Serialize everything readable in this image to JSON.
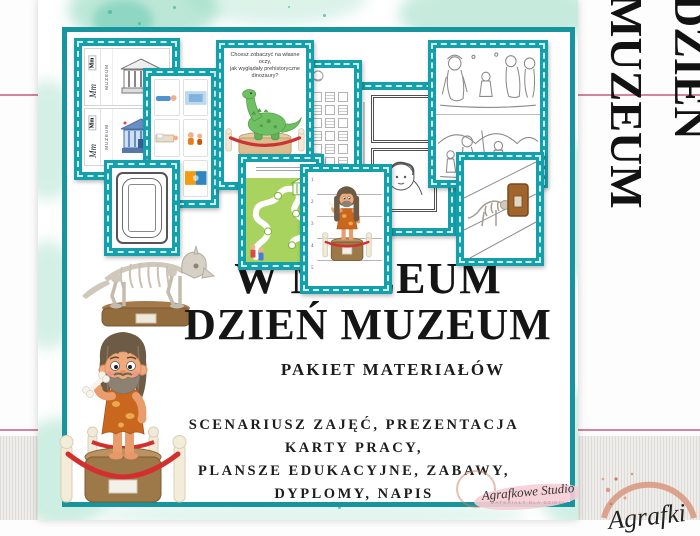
{
  "side_banner": {
    "vertical_text": "DZIEŃ MUZEUM"
  },
  "pin": {
    "title_line1": "W MUZEUM",
    "title_line2": "DZIEŃ MUZEUM",
    "subtitle": "PAKIET MATERIAŁÓW",
    "description_lines": [
      "SCENARIUSZ ZAJĘĆ, PREZENTACJA",
      "KARTY PRACY,",
      "PLANSZE EDUKACYJNE, ZABAWY,",
      "DYPLOMY, NAPIS"
    ],
    "watermark": {
      "name": "Agrafkowe Studio",
      "tagline": "MATERIAŁY DLA DZIECI"
    }
  },
  "corner_logo": {
    "partial_script": "Agrafki"
  },
  "thumbnails": {
    "letter_card": {
      "letters_print": "Mm",
      "letters_cursive": "Mm",
      "word": "MUZEUM"
    },
    "dino_card": {
      "question_lines": [
        "Chcesz zobaczyć na własne oczy,",
        "jak wyglądały prehistoryczne",
        "dinozaury?"
      ],
      "footer_fragment": "ODWI"
    },
    "strips_card": {
      "numbers": [
        "1",
        "2",
        "3",
        "4",
        "5"
      ]
    }
  },
  "colors": {
    "teal_border": "#14a0aa",
    "mint_watercolor": "#9fdcc4",
    "pink_line": "#d4849b",
    "title_text": "#151515",
    "rose_gold": "#d8967f",
    "rope_red": "#d13030",
    "dino_green": "#6fbf63",
    "maze_green": "#a8d35f",
    "pedestal_brown": "#9a7447"
  }
}
